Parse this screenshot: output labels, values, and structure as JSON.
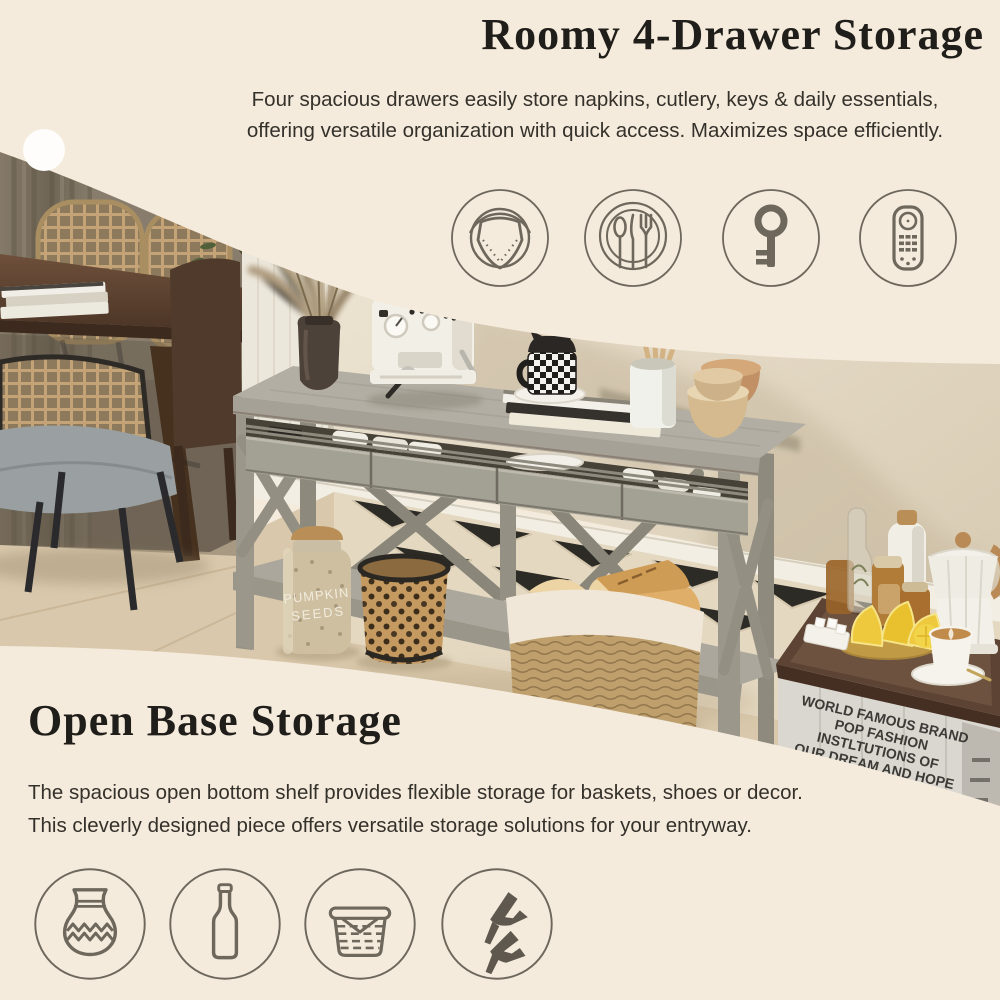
{
  "colors": {
    "background": "#f5ebdc",
    "heading_text": "#201e1a",
    "body_text": "#34312b",
    "icon_stroke": "#6e675c",
    "console_wood": "#a5a196",
    "crate_wood": "#dad7d0",
    "tray_walnut": "#5c4334"
  },
  "top_section": {
    "title": "Roomy 4-Drawer Storage",
    "description_line1": "Four spacious drawers easily store napkins, cutlery, keys & daily essentials,",
    "description_line2": "offering versatile organization with quick access. Maximizes space efficiently.",
    "icons": [
      {
        "name": "napkin-plate-icon"
      },
      {
        "name": "cutlery-plate-icon"
      },
      {
        "name": "key-icon"
      },
      {
        "name": "remote-control-icon"
      }
    ]
  },
  "bottom_section": {
    "title": "Open Base Storage",
    "description_line1": "The spacious open bottom shelf provides flexible storage for baskets, shoes or decor.",
    "description_line2": "This cleverly designed piece offers versatile storage solutions for your entryway.",
    "icons": [
      {
        "name": "vase-icon"
      },
      {
        "name": "bottle-icon"
      },
      {
        "name": "basket-icon"
      },
      {
        "name": "high-heels-icon"
      }
    ]
  },
  "photo": {
    "crate": {
      "brand": "WELLERN",
      "line1": "WORLD FAMOUS BRAND",
      "line2": "POP FASHION",
      "line3": "INSTLTUTIONS OF",
      "line4": "OUR DREAM AND HOPE"
    },
    "jar": {
      "line1": "PUMPKIN",
      "line2": "SEEDS"
    }
  }
}
